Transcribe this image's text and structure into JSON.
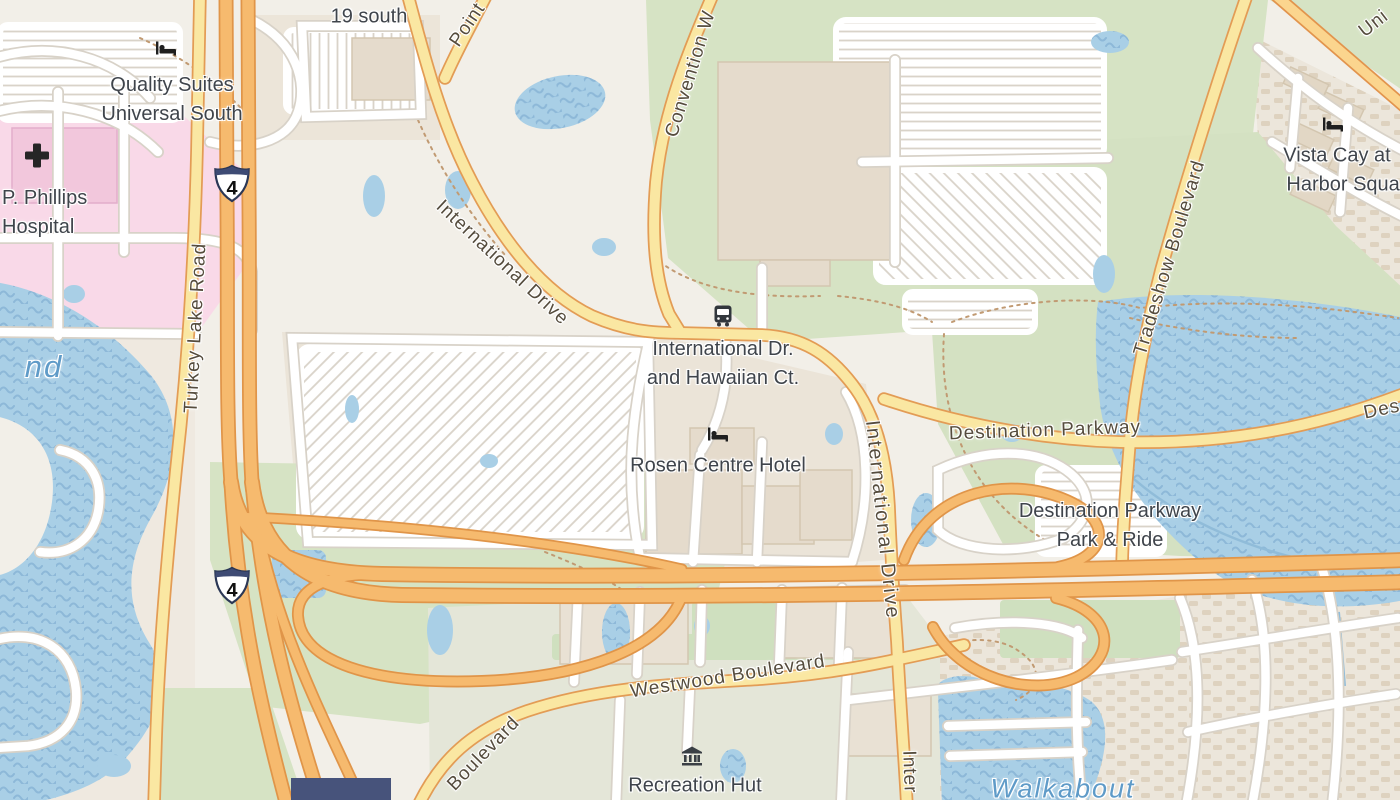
{
  "map_labels": {
    "route_19_south": "19 south",
    "quality_suites_line1": "Quality Suites",
    "quality_suites_line2": "Universal South",
    "phillips_line1": "P. Phillips",
    "phillips_line2": "Hospital",
    "turkey_lake_road": "Turkey Lake Road",
    "pointe_partial": "Point",
    "convention_way_partial": "Convention W",
    "international_drive_nw": "International Drive",
    "bus_stop_line1": "International Dr.",
    "bus_stop_line2": "and Hawaiian Ct.",
    "rosen_centre_hotel": "Rosen Centre Hotel",
    "destination_parkway": "Destination Parkway",
    "park_and_ride_line1": "Destination Parkway",
    "park_and_ride_line2": "Park & Ride",
    "tradeshow_boulevard": "Tradeshow Boulevard",
    "vista_cay_line1": "Vista Cay at",
    "vista_cay_line2": "Harbor Square",
    "universal_partial": "Uni",
    "international_drive_east": "International Drive",
    "international_drive_south_partial": "Inter",
    "westwood_boulevard": "Westwood Boulevard",
    "boulevard_partial": "Boulevard",
    "recreation_hut": "Recreation Hut",
    "walkabout": "Walkabout",
    "lake_name_partial": "nd",
    "destination_parkway_east_partial": "Des"
  },
  "shields": {
    "interstate_4": "4"
  },
  "icons": {
    "hotel": "bed-icon",
    "bus_stop": "bus-icon",
    "hospital": "cross-icon",
    "recreation": "museum-columns-icon"
  },
  "colors": {
    "land": "#f2efe8",
    "residential": "#ece4d8",
    "hospital_area": "#f9d9e8",
    "park_green": "#d6e3c4",
    "scrub_green": "#e4e6d8",
    "water": "#a9cfe6",
    "motorway": "#f6ba6e",
    "secondary_road": "#fae7a2",
    "white_road": "#ffffff",
    "poi_label": "#3f444b",
    "road_label": "#554c3d",
    "water_label": "#5f9bc8"
  }
}
